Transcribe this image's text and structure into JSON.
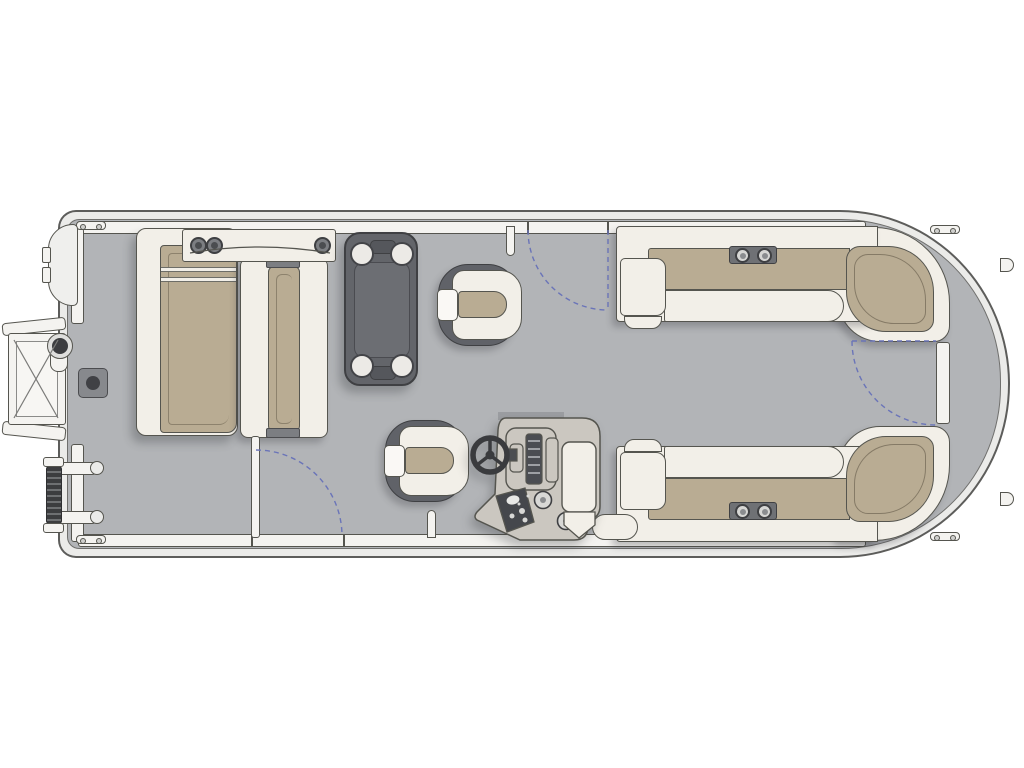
{
  "canvas": {
    "width": 1024,
    "height": 768
  },
  "scene": {
    "type": "pontoon-boat-floor-plan",
    "view": "top-down",
    "orientation": "bow-right-stern-left"
  },
  "colors": {
    "bg": "#ffffff",
    "hull_band": "#ebebe9",
    "line": "#55554f",
    "line_dark": "#3f4043",
    "deck": "#b2b4b7",
    "deck_shade": "#9b9da1",
    "cream": "#f2efe8",
    "tan": "#b9ac93",
    "fixture_dark": "#606268",
    "table_surface": "#6c6e73",
    "console": "#cbc7c0",
    "gate_dash": "#6a74b8",
    "white_trim": "#f4f3f0"
  },
  "components": {
    "stern": [
      "motor-pod",
      "side-boarding-platform",
      "ski-tow-pylon",
      "folded-boarding-ladder",
      "table-pedestal-mount"
    ],
    "port_bow_area": [
      "chaise-lounger-left",
      "chaise-lounger-right",
      "armrest-panel-with-3-cupholders"
    ],
    "center": [
      "removable-table-4-cupholders",
      "companion-swivel-chair",
      "captain-swivel-chair",
      "helm-console-with-steering-wheel"
    ],
    "bow_area": [
      "l-bench-top-with-2-cupholders",
      "l-bench-bottom-with-2-cupholders",
      "corner-wrap-cushions",
      "bow-walkway"
    ],
    "gates": [
      "port-side-gate-open-with-swing-arc",
      "starboard-side-gate-swing-arc",
      "bow-gate-closed-with-swing-arc"
    ],
    "hardware": [
      "cleat-x4",
      "hull-rub-rail",
      "fence-rails",
      "hull-tabs-x2"
    ]
  },
  "counts": {
    "table_cupholders": 4,
    "lounger_panel_cupholders": 3,
    "bench_cupholders": 4,
    "swivel_chairs": 2,
    "gates": 3,
    "cleats": 4
  }
}
